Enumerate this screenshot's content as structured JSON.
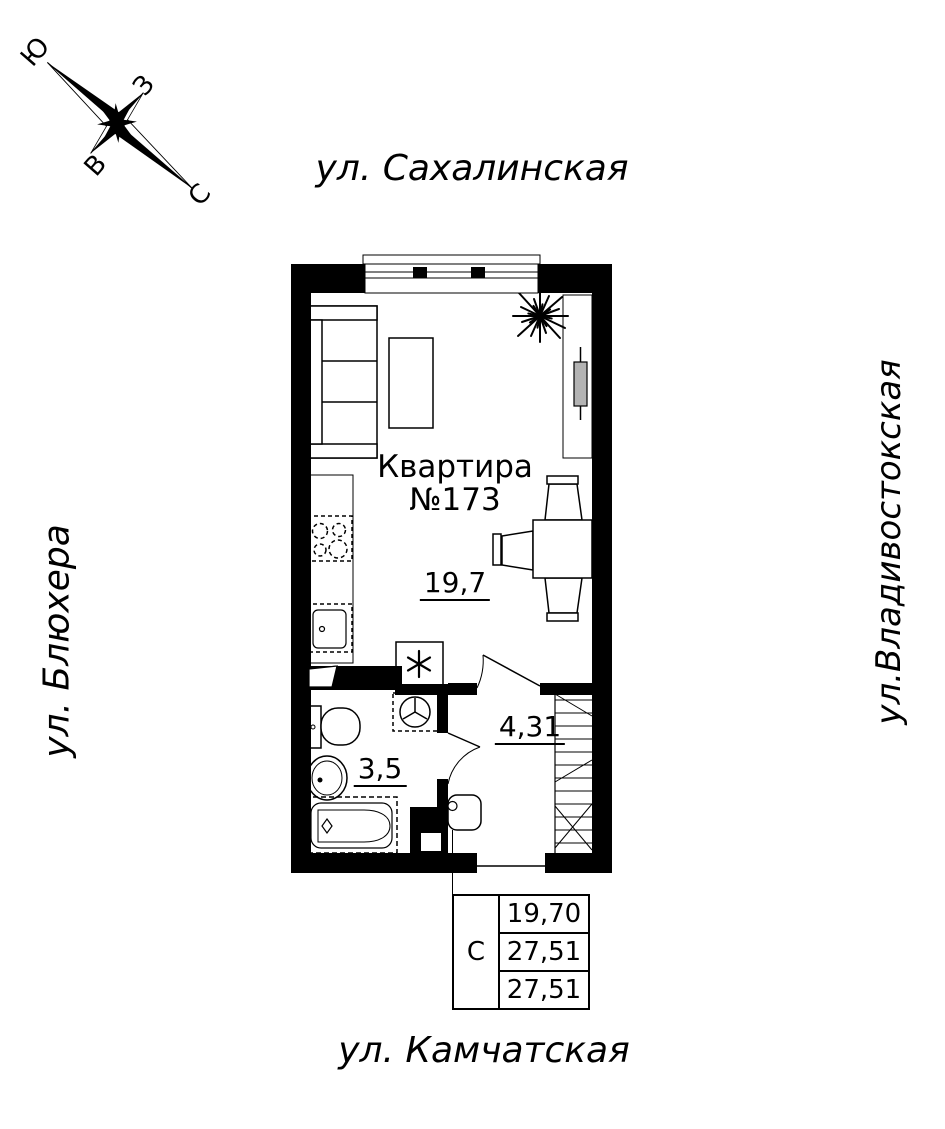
{
  "page": {
    "background": "#ffffff",
    "ink": "#000000"
  },
  "streets": {
    "top": "ул. Сахалинская",
    "left": "ул. Блюхера",
    "right": "ул.Владивостокская",
    "bottom": "ул. Камчатская"
  },
  "compass": {
    "north": "С",
    "south": "Ю",
    "west": "З",
    "east": "В"
  },
  "apartment": {
    "name_line1": "Квартира",
    "name_line2": "№173",
    "number": "173",
    "rooms": [
      {
        "name": "living-room-kitchen",
        "area": "19,7"
      },
      {
        "name": "bathroom",
        "area": "3,5"
      },
      {
        "name": "hallway",
        "area": "4,31"
      }
    ]
  },
  "summary_table": {
    "section": "С",
    "rows": [
      "19,70",
      "27,51",
      "27,51"
    ]
  },
  "plan_symbols": {
    "refrigerator": "asterisk-snowflake-icon",
    "washing_machine": "circle-tripod-icon",
    "compass": "north-arrow-icon",
    "plant": "starburst-icon"
  }
}
